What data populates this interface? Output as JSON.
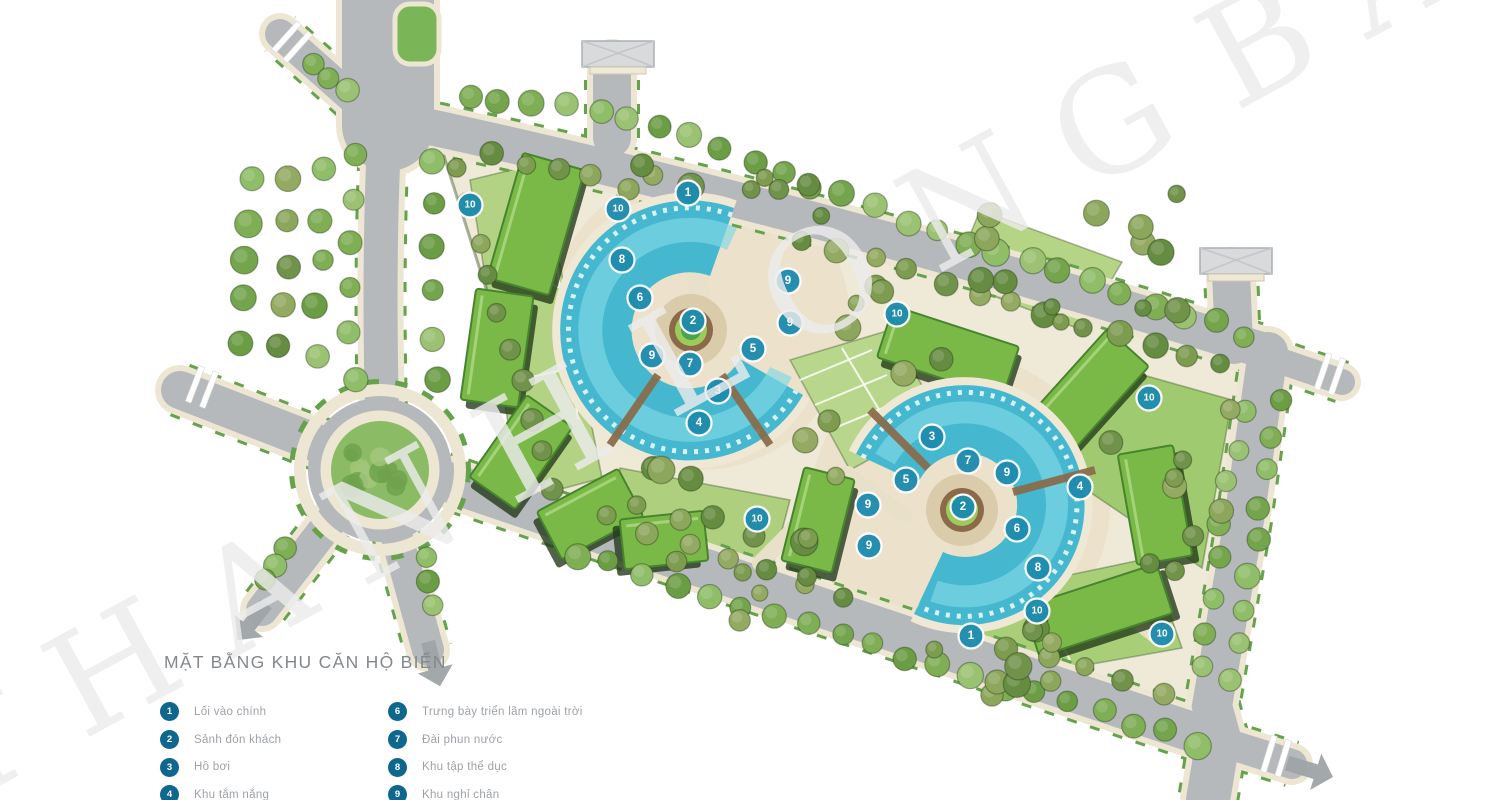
{
  "watermark": {
    "text": "THANH LONG BAY",
    "color": "#ebebeb"
  },
  "legend": {
    "title": "MẶT BẰNG KHU CĂN HỘ BIỂN",
    "circle_color": "#0f678e",
    "columns": [
      [
        {
          "number": "1",
          "label": "Lối vào chính"
        },
        {
          "number": "2",
          "label": "Sảnh đón khách"
        },
        {
          "number": "3",
          "label": "Hồ bơi"
        },
        {
          "number": "4",
          "label": "Khu tắm nắng"
        }
      ],
      [
        {
          "number": "6",
          "label": "Trưng bày triển lãm ngoài trời"
        },
        {
          "number": "7",
          "label": "Đài phun nước"
        },
        {
          "number": "8",
          "label": "Khu tập thể dục"
        },
        {
          "number": "9",
          "label": "Khu nghỉ chân"
        }
      ]
    ]
  },
  "plan": {
    "marker_color": "#1e8cae",
    "markers": [
      {
        "n": "10",
        "x": 470,
        "y": 205
      },
      {
        "n": "10",
        "x": 618,
        "y": 209
      },
      {
        "n": "1",
        "x": 688,
        "y": 193
      },
      {
        "n": "8",
        "x": 622,
        "y": 260
      },
      {
        "n": "6",
        "x": 640,
        "y": 298
      },
      {
        "n": "9",
        "x": 788,
        "y": 281
      },
      {
        "n": "9",
        "x": 790,
        "y": 323
      },
      {
        "n": "2",
        "x": 693,
        "y": 321
      },
      {
        "n": "5",
        "x": 753,
        "y": 349
      },
      {
        "n": "9",
        "x": 652,
        "y": 356
      },
      {
        "n": "7",
        "x": 690,
        "y": 364
      },
      {
        "n": "3",
        "x": 718,
        "y": 391
      },
      {
        "n": "4",
        "x": 699,
        "y": 423
      },
      {
        "n": "10",
        "x": 897,
        "y": 314
      },
      {
        "n": "10",
        "x": 1149,
        "y": 398
      },
      {
        "n": "3",
        "x": 932,
        "y": 437
      },
      {
        "n": "7",
        "x": 968,
        "y": 461
      },
      {
        "n": "9",
        "x": 1007,
        "y": 473
      },
      {
        "n": "5",
        "x": 906,
        "y": 480
      },
      {
        "n": "4",
        "x": 1080,
        "y": 487
      },
      {
        "n": "2",
        "x": 963,
        "y": 507
      },
      {
        "n": "9",
        "x": 868,
        "y": 505
      },
      {
        "n": "10",
        "x": 757,
        "y": 519
      },
      {
        "n": "6",
        "x": 1017,
        "y": 529
      },
      {
        "n": "9",
        "x": 869,
        "y": 546
      },
      {
        "n": "8",
        "x": 1038,
        "y": 568
      },
      {
        "n": "10",
        "x": 1037,
        "y": 611
      },
      {
        "n": "1",
        "x": 971,
        "y": 636
      },
      {
        "n": "10",
        "x": 1162,
        "y": 634
      }
    ]
  }
}
